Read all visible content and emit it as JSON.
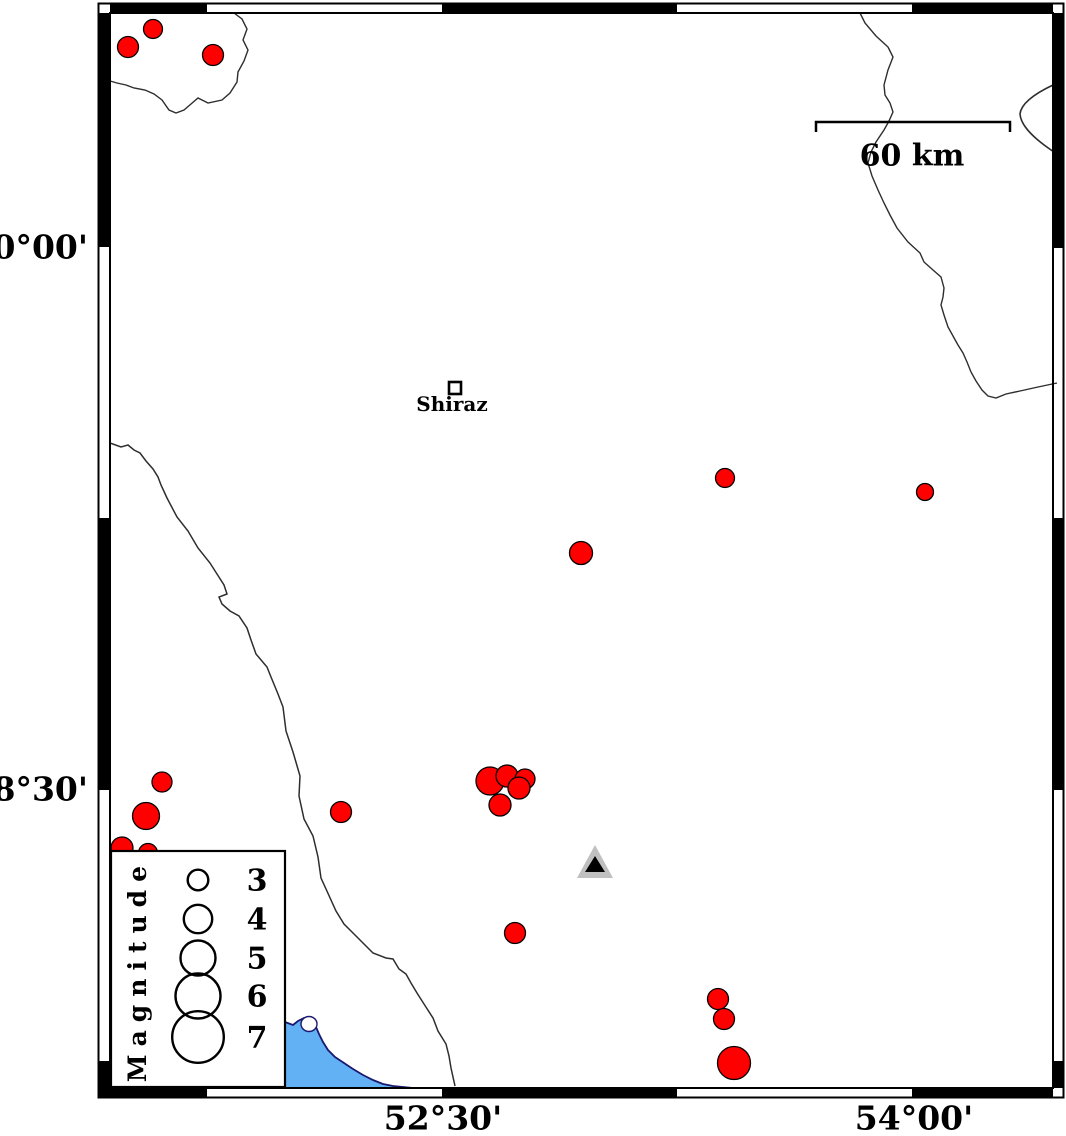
{
  "map": {
    "kind": "seismicity-map",
    "axis": {
      "lat_labels": [
        {
          "text": "30°00'",
          "x": 88,
          "y": 247
        },
        {
          "text": "28°30'",
          "x": 88,
          "y": 789
        }
      ],
      "lon_labels": [
        {
          "text": "52°30'",
          "x": 443,
          "y": 1118
        },
        {
          "text": "54°00'",
          "x": 914,
          "y": 1118
        }
      ]
    },
    "scale_bar": {
      "label": "60 km",
      "x1": 816,
      "x2": 1010,
      "y": 122,
      "tick_drop": 10
    },
    "city": {
      "label": "Shiraz",
      "x": 455,
      "y": 388,
      "approx_lon": 52.54,
      "approx_lat": 29.61
    },
    "station": {
      "x": 595,
      "y": 862,
      "approx_lon": 52.99,
      "approx_lat": 28.3
    },
    "legend": {
      "title": "Magnitude",
      "circle_cx": 198,
      "value_cx": 257,
      "entries": [
        {
          "label": "3",
          "r": 10.3,
          "cy": 880
        },
        {
          "label": "4",
          "r": 14.2,
          "cy": 919
        },
        {
          "label": "5",
          "r": 17.5,
          "cy": 958
        },
        {
          "label": "6",
          "r": 22.5,
          "cy": 996
        },
        {
          "label": "7",
          "r": 25.8,
          "cy": 1037
        }
      ]
    },
    "epicenters": [
      {
        "x": 153,
        "y": 29,
        "r": 9.5,
        "approx_lon": 51.58,
        "approx_lat": 30.6
      },
      {
        "x": 128,
        "y": 47,
        "r": 10.5,
        "approx_lon": 51.5,
        "approx_lat": 30.55
      },
      {
        "x": 213,
        "y": 55,
        "r": 10.5,
        "approx_lon": 51.77,
        "approx_lat": 30.53
      },
      {
        "x": 725,
        "y": 478,
        "r": 9.5,
        "approx_lon": 53.4,
        "approx_lat": 29.36
      },
      {
        "x": 925,
        "y": 492,
        "r": 8.5,
        "approx_lon": 54.04,
        "approx_lat": 29.32
      },
      {
        "x": 581,
        "y": 553,
        "r": 11.5,
        "approx_lon": 52.94,
        "approx_lat": 29.15
      },
      {
        "x": 162,
        "y": 782,
        "r": 10.0,
        "approx_lon": 51.61,
        "approx_lat": 28.52
      },
      {
        "x": 146,
        "y": 816,
        "r": 13.5,
        "approx_lon": 51.56,
        "approx_lat": 28.43
      },
      {
        "x": 122,
        "y": 848,
        "r": 11.0,
        "approx_lon": 51.48,
        "approx_lat": 28.34
      },
      {
        "x": 148,
        "y": 853,
        "r": 9.5,
        "approx_lon": 51.56,
        "approx_lat": 28.33
      },
      {
        "x": 341,
        "y": 812,
        "r": 10.5,
        "approx_lon": 52.18,
        "approx_lat": 28.44
      },
      {
        "x": 490,
        "y": 781,
        "r": 14.0,
        "approx_lon": 52.65,
        "approx_lat": 28.52
      },
      {
        "x": 507,
        "y": 776,
        "r": 11.0,
        "approx_lon": 52.71,
        "approx_lat": 28.54
      },
      {
        "x": 525,
        "y": 779,
        "r": 10.0,
        "approx_lon": 52.76,
        "approx_lat": 28.53
      },
      {
        "x": 519,
        "y": 788,
        "r": 11.0,
        "approx_lon": 52.75,
        "approx_lat": 28.5
      },
      {
        "x": 500,
        "y": 805,
        "r": 11.0,
        "approx_lon": 52.69,
        "approx_lat": 28.46
      },
      {
        "x": 515,
        "y": 933,
        "r": 10.5,
        "approx_lon": 52.73,
        "approx_lat": 28.1
      },
      {
        "x": 718,
        "y": 999,
        "r": 10.5,
        "approx_lon": 53.38,
        "approx_lat": 27.92
      },
      {
        "x": 724,
        "y": 1019,
        "r": 10.5,
        "approx_lon": 53.4,
        "approx_lat": 27.87
      },
      {
        "x": 734,
        "y": 1063,
        "r": 16.5,
        "approx_lon": 53.43,
        "approx_lat": 27.75
      }
    ],
    "colors": {
      "epicenter_fill": "#ff0000",
      "epicenter_stroke": "#000000",
      "water_fill": "#63b1f5",
      "water_stroke": "#191970",
      "station_gray": "#c0c0c0",
      "station_black": "#000000",
      "line": "#2e2e2e",
      "frame": "#000000"
    }
  }
}
